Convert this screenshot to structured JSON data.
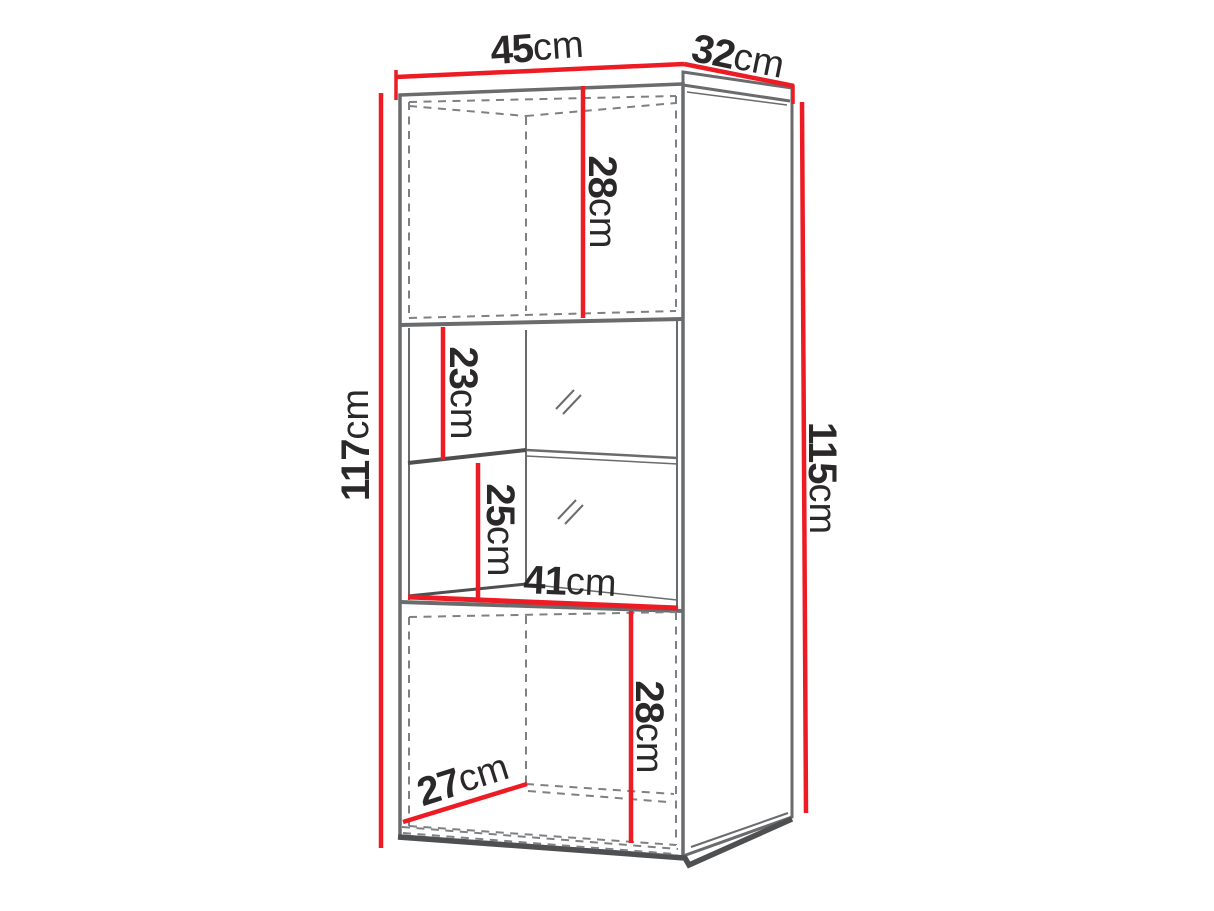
{
  "diagram": {
    "type": "furniture-dimension-drawing",
    "background": "#ffffff",
    "colors": {
      "dimension_line": "#ed1c24",
      "outline": "#6a6b6d",
      "outline_dark": "#4e4f51",
      "hidden_edge": "#7f8083",
      "label_text": "#2b2829"
    },
    "dimensions": {
      "top_width": {
        "value": "45",
        "unit": "cm"
      },
      "top_depth": {
        "value": "32",
        "unit": "cm"
      },
      "upper_door_height": {
        "value": "28",
        "unit": "cm"
      },
      "upper_compartment_height": {
        "value": "23",
        "unit": "cm"
      },
      "lower_compartment_height": {
        "value": "25",
        "unit": "cm"
      },
      "interior_width": {
        "value": "41",
        "unit": "cm"
      },
      "front_height": {
        "value": "117",
        "unit": "cm"
      },
      "side_height": {
        "value": "115",
        "unit": "cm"
      },
      "lower_door_height": {
        "value": "28",
        "unit": "cm"
      },
      "interior_depth": {
        "value": "27",
        "unit": "cm"
      }
    }
  }
}
